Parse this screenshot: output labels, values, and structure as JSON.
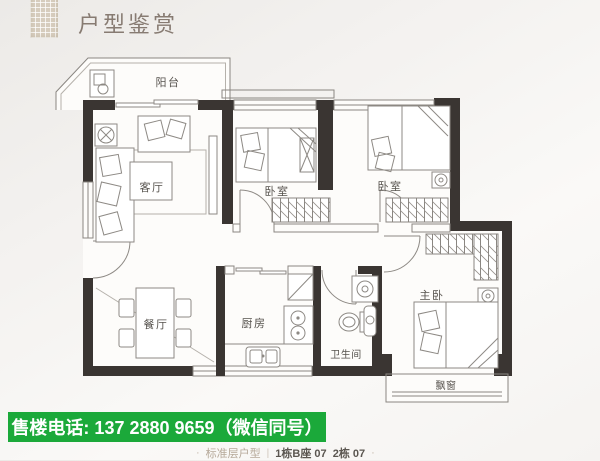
{
  "header": {
    "title": "户型鉴赏"
  },
  "floor_plan": {
    "rooms": [
      {
        "id": "balcony",
        "label": "阳台"
      },
      {
        "id": "living-room",
        "label": "客厅"
      },
      {
        "id": "bedroom-1",
        "label": "卧室"
      },
      {
        "id": "bedroom-2",
        "label": "卧室"
      },
      {
        "id": "master-bedroom",
        "label": "主卧"
      },
      {
        "id": "dining-room",
        "label": "餐厅"
      },
      {
        "id": "kitchen",
        "label": "厨房"
      },
      {
        "id": "bathroom",
        "label": "卫生间"
      },
      {
        "id": "bay-window",
        "label": "飘窗"
      }
    ]
  },
  "footer": {
    "phone_banner": "售楼电话: 137 2880 9659（微信同号）",
    "caption": {
      "lead_dot": "·",
      "unit_type": "标准层户型",
      "separator": "|",
      "units": "1栋B座 07  2栋 07",
      "tail_dot": "·"
    }
  },
  "colors": {
    "banner_green": "#1ba93a",
    "wall_dark": "#3a3532",
    "title_brown": "#877b72",
    "logo_beige": "#d6ccbd"
  }
}
